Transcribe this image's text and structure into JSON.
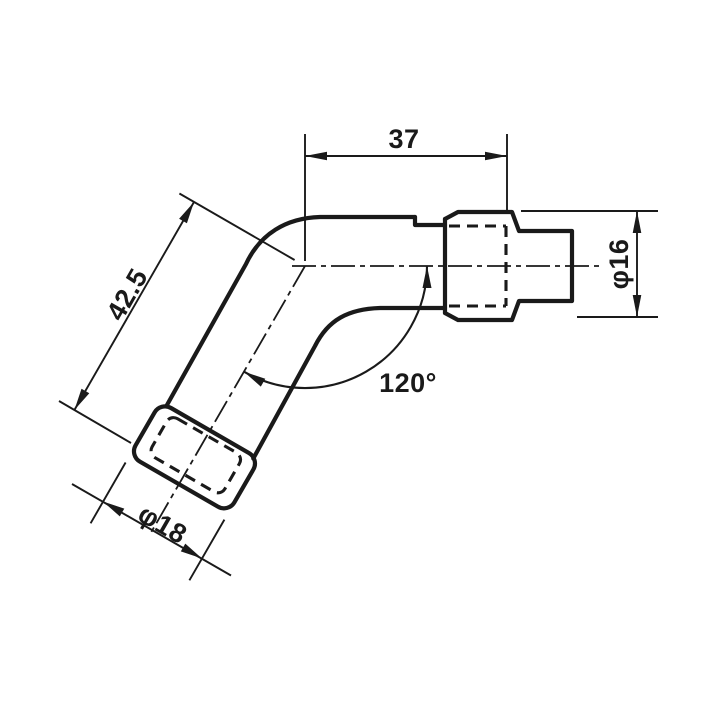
{
  "drawing": {
    "background_color": "#ffffff",
    "ink_color": "#1a1a1a",
    "dimensions": {
      "top_width": {
        "label": "37"
      },
      "side_length": {
        "label": "42.5"
      },
      "terminal_diameter": {
        "label": "φ16"
      },
      "boot_diameter": {
        "label": "φ18"
      },
      "elbow_angle": {
        "label": "120°"
      }
    }
  }
}
